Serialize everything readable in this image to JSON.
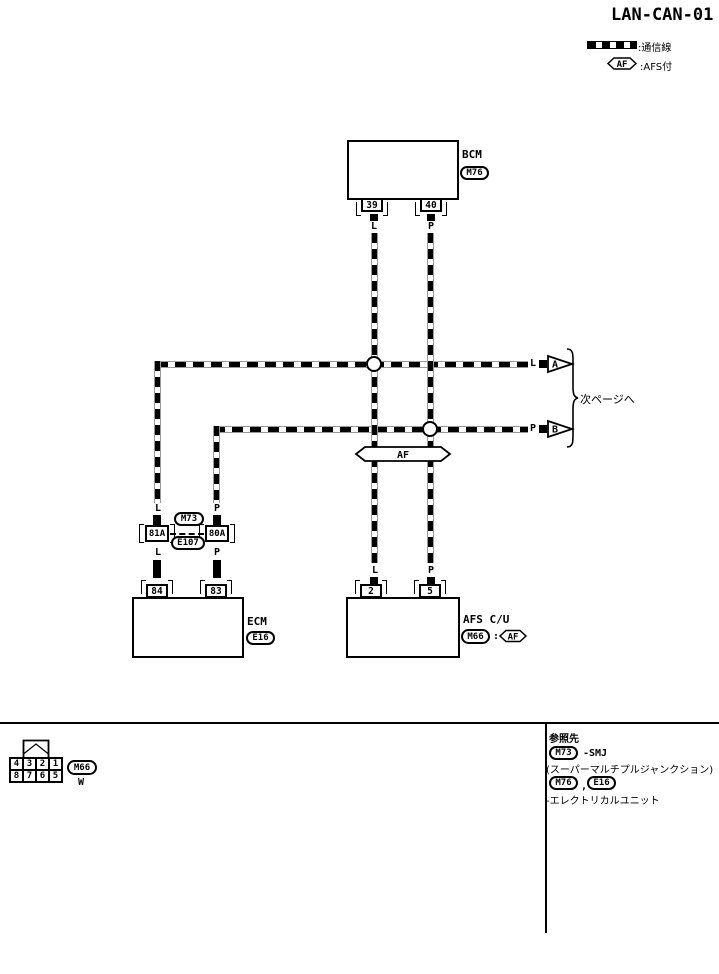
{
  "title": "LAN-CAN-01",
  "legend": {
    "comm_line_label": ":通信線",
    "af_tag": "AF",
    "afs_label": ":AFS付"
  },
  "wires": {
    "l": "L",
    "p": "P"
  },
  "bcm": {
    "name": "BCM",
    "connector": "M76",
    "can_h_label": "CAN-H",
    "can_h_pin": "39",
    "can_l_label": "CAN-L",
    "can_l_pin": "40"
  },
  "junction": {
    "af_tag": "AF",
    "arrow_a": "A",
    "arrow_b": "B",
    "next_page": "次ページへ"
  },
  "smj": {
    "connector_top": "M73",
    "connector_bottom": "E107",
    "terminal_left": "81A",
    "terminal_right": "80A"
  },
  "ecm": {
    "name": "ECM",
    "connector": "E16",
    "can_h_label": "CAN-H",
    "can_h_pin": "84",
    "can_l_label": "CAN-L",
    "can_l_pin": "83"
  },
  "afs_cu": {
    "name": "AFS C/U",
    "connector": "M66",
    "colon": ":",
    "af_tag": "AF",
    "can_h_label": "CAN-H",
    "can_h_pin": "2",
    "can_l_label": "CAN-L",
    "can_l_pin": "5"
  },
  "footer": {
    "pin_grid": [
      "4",
      "3",
      "2",
      "1",
      "8",
      "7",
      "6",
      "5"
    ],
    "connector": "M66",
    "color_code": "W",
    "notes": {
      "heading": "参照先",
      "ref1_connector": "M73",
      "ref1_text": "-SMJ",
      "ref1_text2": "(スーパーマルチプルジャンクション)",
      "ref2_connector_a": "M76",
      "ref2_separator": ",",
      "ref2_connector_b": "E16",
      "ref2_text": "-エレクトリカルユニット"
    }
  }
}
